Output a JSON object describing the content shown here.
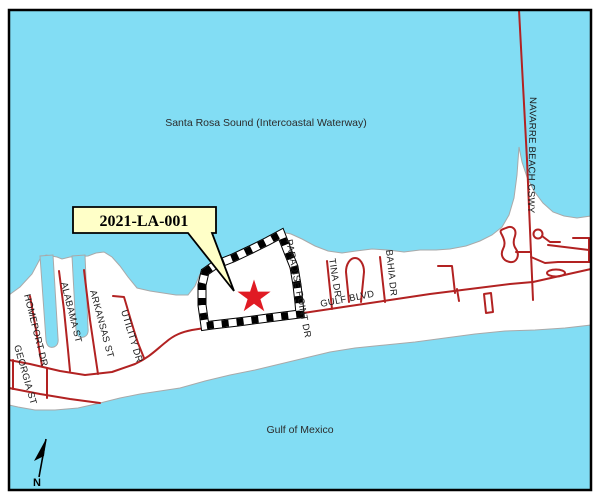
{
  "map": {
    "title_none": "",
    "colors": {
      "water": "#82DDF4",
      "land": "#FFFFFF",
      "shoreline": "#A9A9A9",
      "road": "#B22222",
      "star": "#E01B24",
      "boundary": "#000000",
      "callout_fill": "#FFFFC8",
      "callout_border": "#000000",
      "label": "#1A1A1A",
      "frame": "#000000"
    },
    "water_labels": {
      "sound": "Santa Rosa Sound (Intercoastal Waterway)",
      "gulf": "Gulf of Mexico"
    },
    "callout": {
      "case_number": "2021-LA-001"
    },
    "parcel": {
      "marker": "red-star",
      "boundary_style": "black-white-dashed"
    },
    "streets": [
      {
        "id": "homeport-dr",
        "label": "HOMEPORT DR"
      },
      {
        "id": "georgia-st",
        "label": "GEORGIA ST"
      },
      {
        "id": "alabama-st",
        "label": "ALABAMA ST"
      },
      {
        "id": "arkansas-st",
        "label": "ARKANSAS ST"
      },
      {
        "id": "utility-dr",
        "label": "UTILITY DR"
      },
      {
        "id": "paradise-point-dr",
        "label": "PARADISE POINT DR"
      },
      {
        "id": "tina-dr",
        "label": "TINA DR"
      },
      {
        "id": "gulf-blvd",
        "label": "GULF BLVD"
      },
      {
        "id": "bahia-dr",
        "label": "BAHIA DR"
      },
      {
        "id": "navarre-beach-cswy",
        "label": "NAVARRE BEACH CSWY"
      }
    ],
    "north_arrow": {
      "label": "N"
    }
  }
}
